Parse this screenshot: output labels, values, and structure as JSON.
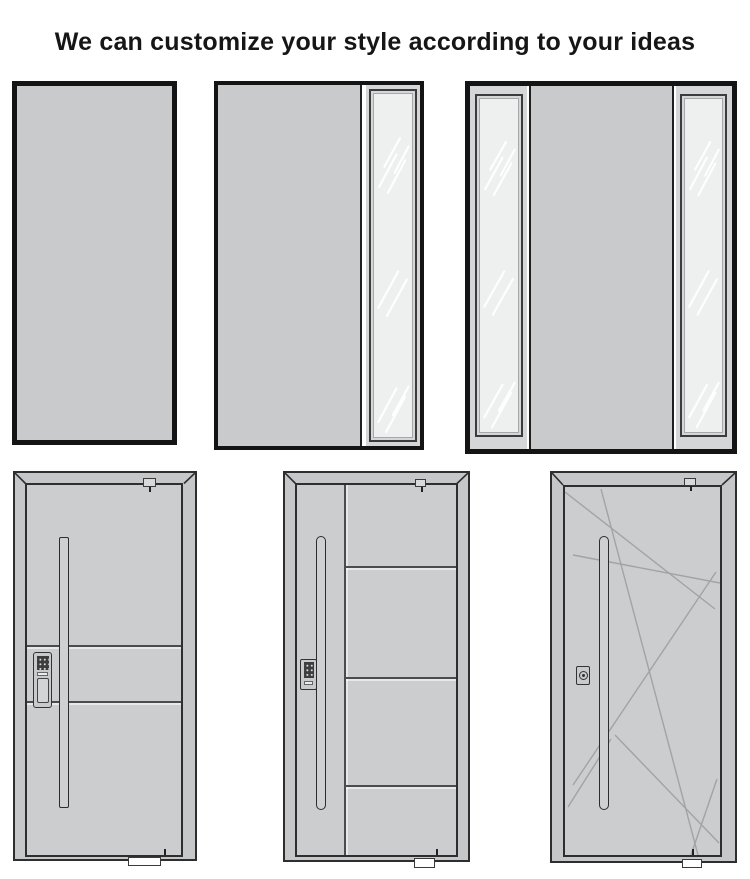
{
  "title": "We can customize your style according to your ideas",
  "figures": {
    "top_row": [
      {
        "id": "config-solid",
        "name": "single solid door panel"
      },
      {
        "id": "config-right-sidelight",
        "name": "door with right glass sidelight"
      },
      {
        "id": "config-double-sidelight",
        "name": "door with left and right glass sidelights"
      }
    ],
    "bottom_row": [
      {
        "id": "design-horizontal-grooves",
        "name": "door with long bar handle, keypad lock and two horizontal grooves"
      },
      {
        "id": "design-stile-grooves",
        "name": "door with long bar handle, keypad lock, vertical stile and three grooves"
      },
      {
        "id": "design-abstract-lines",
        "name": "door with long bar handle, cylinder lock and abstract line pattern"
      }
    ]
  },
  "colors": {
    "door_gray": "#c9cacb",
    "leaf_gray": "#cccdce",
    "frame_gray": "#c6c7c8",
    "glass": "#eef0ef",
    "glass_frame_gray": "#d5d6d7",
    "outline_black": "#141414",
    "outline_dark": "#2e2e2e",
    "groove_line": "#4c4c4c",
    "pattern_line": "#a2a3a4",
    "streak_white": "#ffffff"
  }
}
